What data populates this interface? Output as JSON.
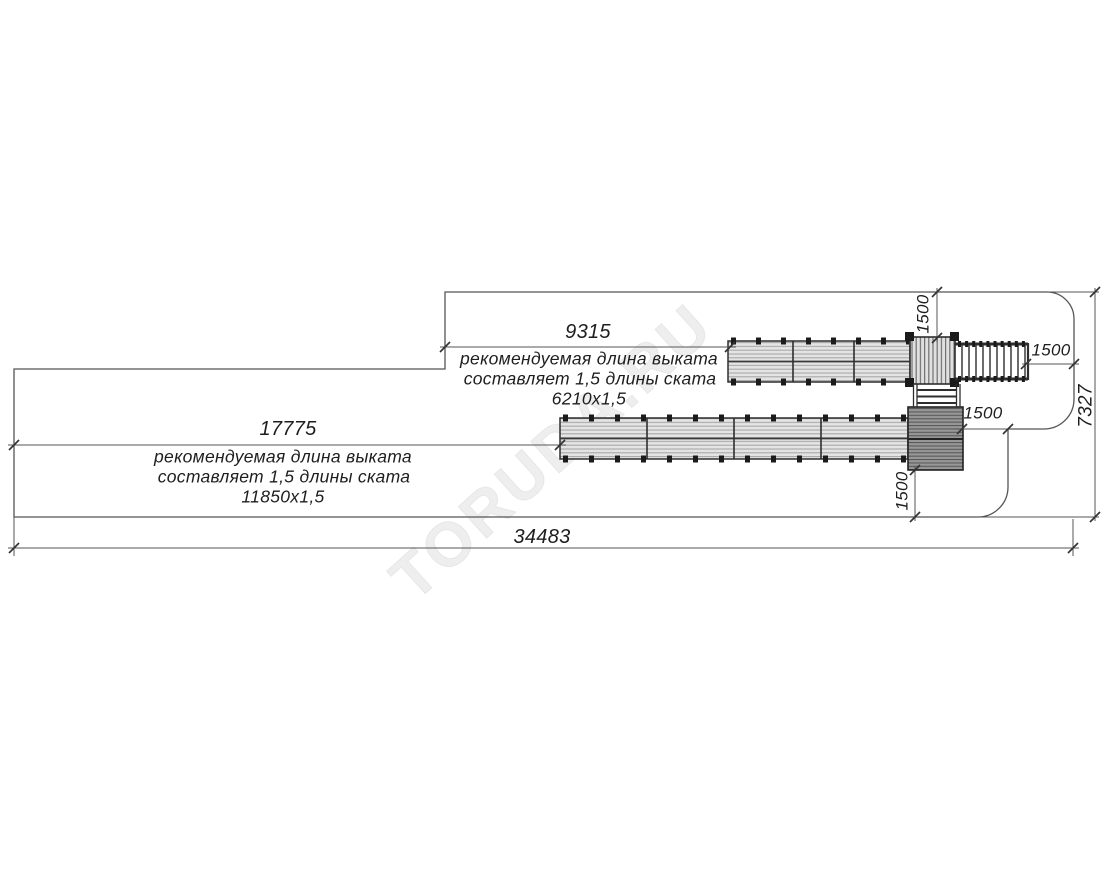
{
  "drawing": {
    "type": "site-plan-top-view",
    "watermark": "TORUDA.RU",
    "upper_runout": {
      "dim": "9315",
      "note_line1": "рекомендуемая длина выката",
      "note_line2": "составляет 1,5 длины ската",
      "note_line3": "6210x1,5"
    },
    "lower_runout": {
      "dim": "17775",
      "note_line1": "рекомендуемая длина выката",
      "note_line2": "составляет 1,5 длины ската",
      "note_line3": "11850x1,5"
    },
    "overall_width": "34483",
    "overall_height": "7327",
    "clearance_top": "1500",
    "clearance_right": "1500",
    "clearance_middle": "1500",
    "clearance_bottom": "1500",
    "colors": {
      "line": "#555555",
      "structure": "#2e2e2e",
      "slide_fill": "#e4e4e4",
      "hill_fill": "#979797",
      "background": "#ffffff"
    }
  }
}
